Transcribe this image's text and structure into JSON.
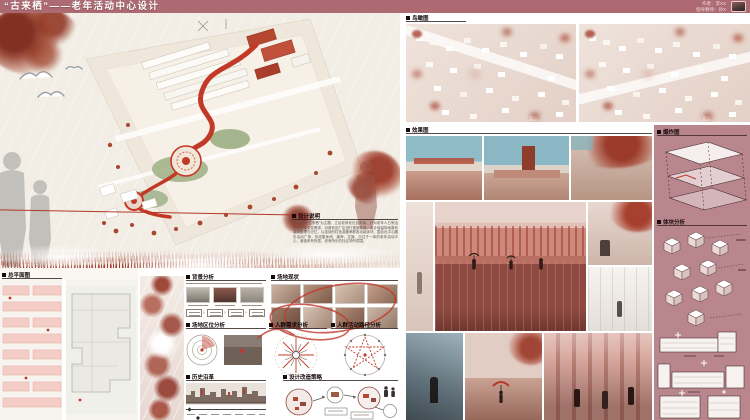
{
  "banner": {
    "title": "“古来栖”——老年活动中心设计",
    "author_line1": "作者：李XX",
    "author_line2": "指导教师：孙X",
    "bg_color": "#ad6a72"
  },
  "sections": {
    "design_notes": {
      "label": "设计说明",
      "body": "本方案以“古来栖”为主题，立足老龄化社会背景，针对老年人日常活动与精神文化需求，对原有旧厂区进行更新改造。设计保留场地原有建筑肌理与记忆，以连续的红色游廊串联各功能体块，围合出中心圆形活动广场，形成集休闲、康养、文娱、交往于一体的老年活动中心，营造老有所居、老有所乐的社区场所氛围。"
    },
    "site_plan": {
      "label": "总平面图"
    },
    "background": {
      "label": "背景分析"
    },
    "site_status": {
      "label": "场地现状"
    },
    "site_location": {
      "label": "场地区位分析"
    },
    "crowd_needs": {
      "label": "人群需求分析"
    },
    "crowd_path": {
      "label": "人群活动路径分析"
    },
    "history": {
      "label": "历史沿革"
    },
    "strategy": {
      "label": "设计改造策略"
    },
    "birdview": {
      "label": "鸟瞰图"
    },
    "renders": {
      "label": "效果图"
    },
    "exploded": {
      "label": "爆炸图"
    },
    "massing": {
      "label": "体块分析"
    }
  },
  "colors": {
    "banner": "#ad6a72",
    "accent_red": "#c0392b",
    "panel_pink": "#b8868c",
    "cream": "#f2ede5"
  }
}
